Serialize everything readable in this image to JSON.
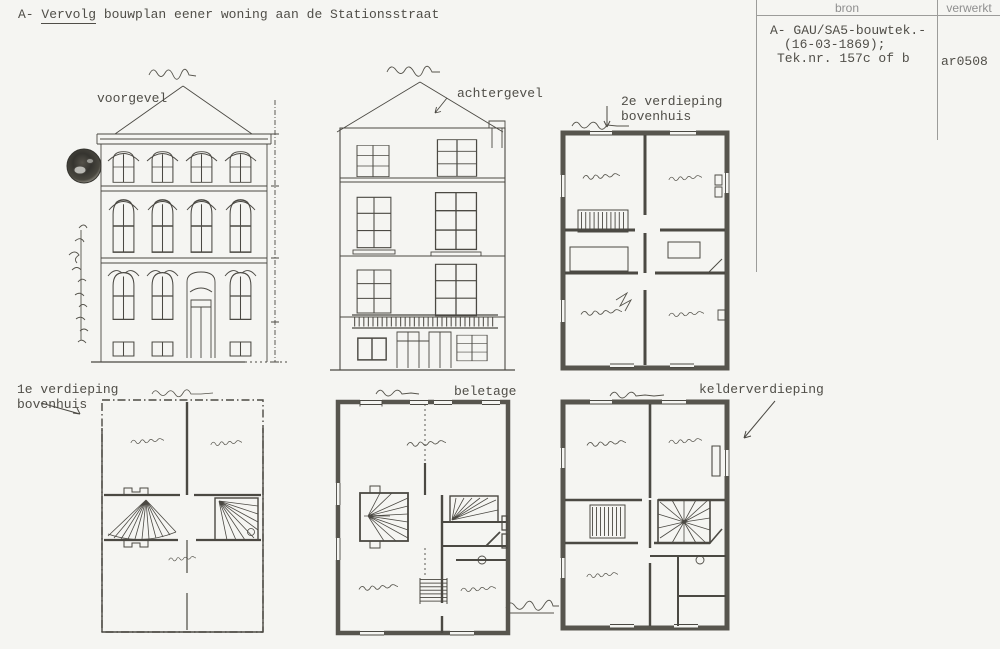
{
  "document": {
    "title": {
      "prefix": "A- ",
      "emphasized": "Vervolg",
      "rest": " bouwplan eener woning aan de Stationsstraat"
    }
  },
  "index_table": {
    "col_bron": "bron",
    "col_verwerkt": "verwerkt",
    "bron_line1": "A- GAU/SA5-bouwtek.-",
    "bron_line2": "(16-03-1869);",
    "bron_line3": "Tek.nr. 157c of b",
    "verwerkt_value": "ar0508"
  },
  "labels": {
    "voorgevel": "voorgevel",
    "achtergevel": "achtergevel",
    "verdieping2_line1": "2e verdieping",
    "verdieping2_line2": "bovenhuis",
    "verdieping1_line1": "1e verdieping",
    "verdieping1_line2": "bovenhuis",
    "beletage": "beletage",
    "kelder": "kelderverdieping"
  },
  "colors": {
    "paper": "#f5f5f2",
    "ink": "#4b4943",
    "typed_text": "#504e48",
    "table_header_text": "#8f8f8f"
  }
}
